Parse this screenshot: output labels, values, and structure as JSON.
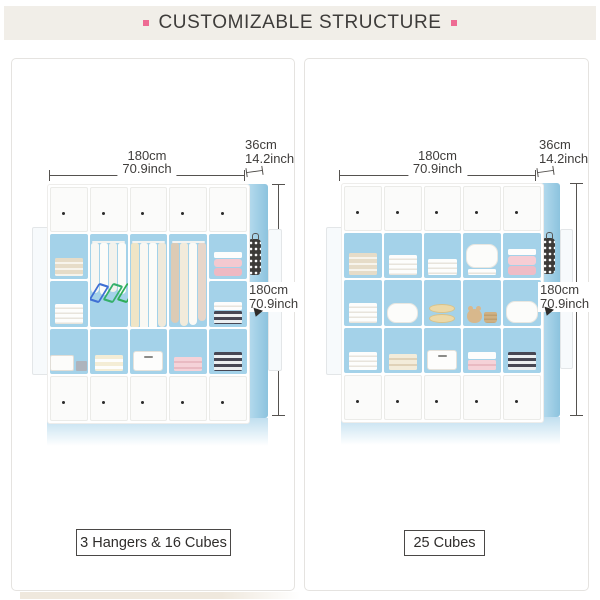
{
  "title": "CUSTOMIZABLE STRUCTURE",
  "accent_color": "#ee6b93",
  "band_color": "#f1eee8",
  "wardrobe_blue": "#a4d2e9",
  "panels": [
    {
      "label": "3 Hangers & 16 Cubes",
      "dimensions": {
        "width_cm": "180cm",
        "width_in": "70.9inch",
        "depth_cm": "36cm",
        "depth_in": "14.2inch",
        "height_cm": "180cm",
        "height_in": "70.9inch"
      }
    },
    {
      "label": "25 Cubes",
      "dimensions": {
        "width_cm": "180cm",
        "width_in": "70.9inch",
        "depth_cm": "36cm",
        "depth_in": "14.2inch",
        "height_cm": "180cm",
        "height_in": "70.9inch"
      }
    }
  ]
}
